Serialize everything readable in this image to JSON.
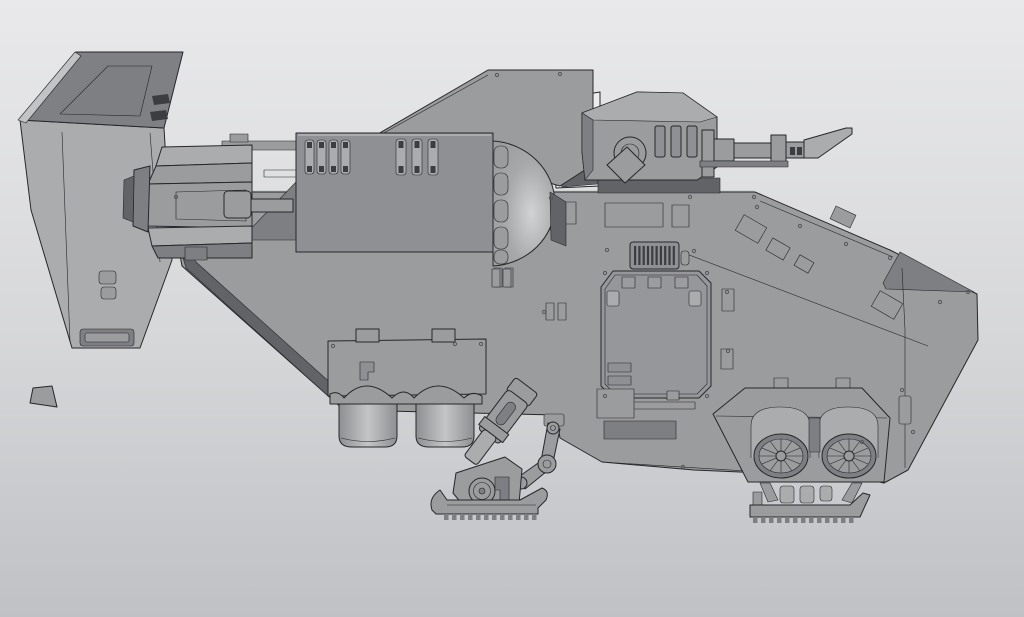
{
  "canvas": {
    "width": 1024,
    "height": 617
  },
  "scene": {
    "type": "3d-model-render",
    "subject": "gunship-side-view",
    "view": "side profile, facing left, landed on landing skids"
  },
  "colors": {
    "bg_top": "#e9e9eb",
    "bg_mid": "#d6d7d9",
    "bg_bottom": "#bfc1c5",
    "outline": "#26272b",
    "hull": "#9b9c9e",
    "hull_light": "#abacae",
    "hull_lighter": "#c2c3c5",
    "hull_dark": "#7e7f82",
    "hull_darker": "#626366",
    "panel": "#8f9093",
    "door": "#96979a",
    "slot": "#3c3d40",
    "roof": "#7f8084",
    "white_piece": "#ededef",
    "edge_light": "#c6c7c9",
    "rivet": "#55565a",
    "dome_hi": "#d2d3d5",
    "dome_mid": "#a7a8aa",
    "cyl_edge": "#8e8f91",
    "cyl_hi": "#c4c5c7"
  },
  "components": [
    "tail-wing-box",
    "nose-engine-cluster",
    "canopy-vent-panel",
    "engine-dome-cowl",
    "dorsal-fin",
    "turret",
    "cannon-barrel",
    "main-hull",
    "side-door",
    "intake-grille",
    "front-thruster-pod",
    "front-landing-gear",
    "rear-fan-assembly",
    "rear-landing-skid"
  ]
}
